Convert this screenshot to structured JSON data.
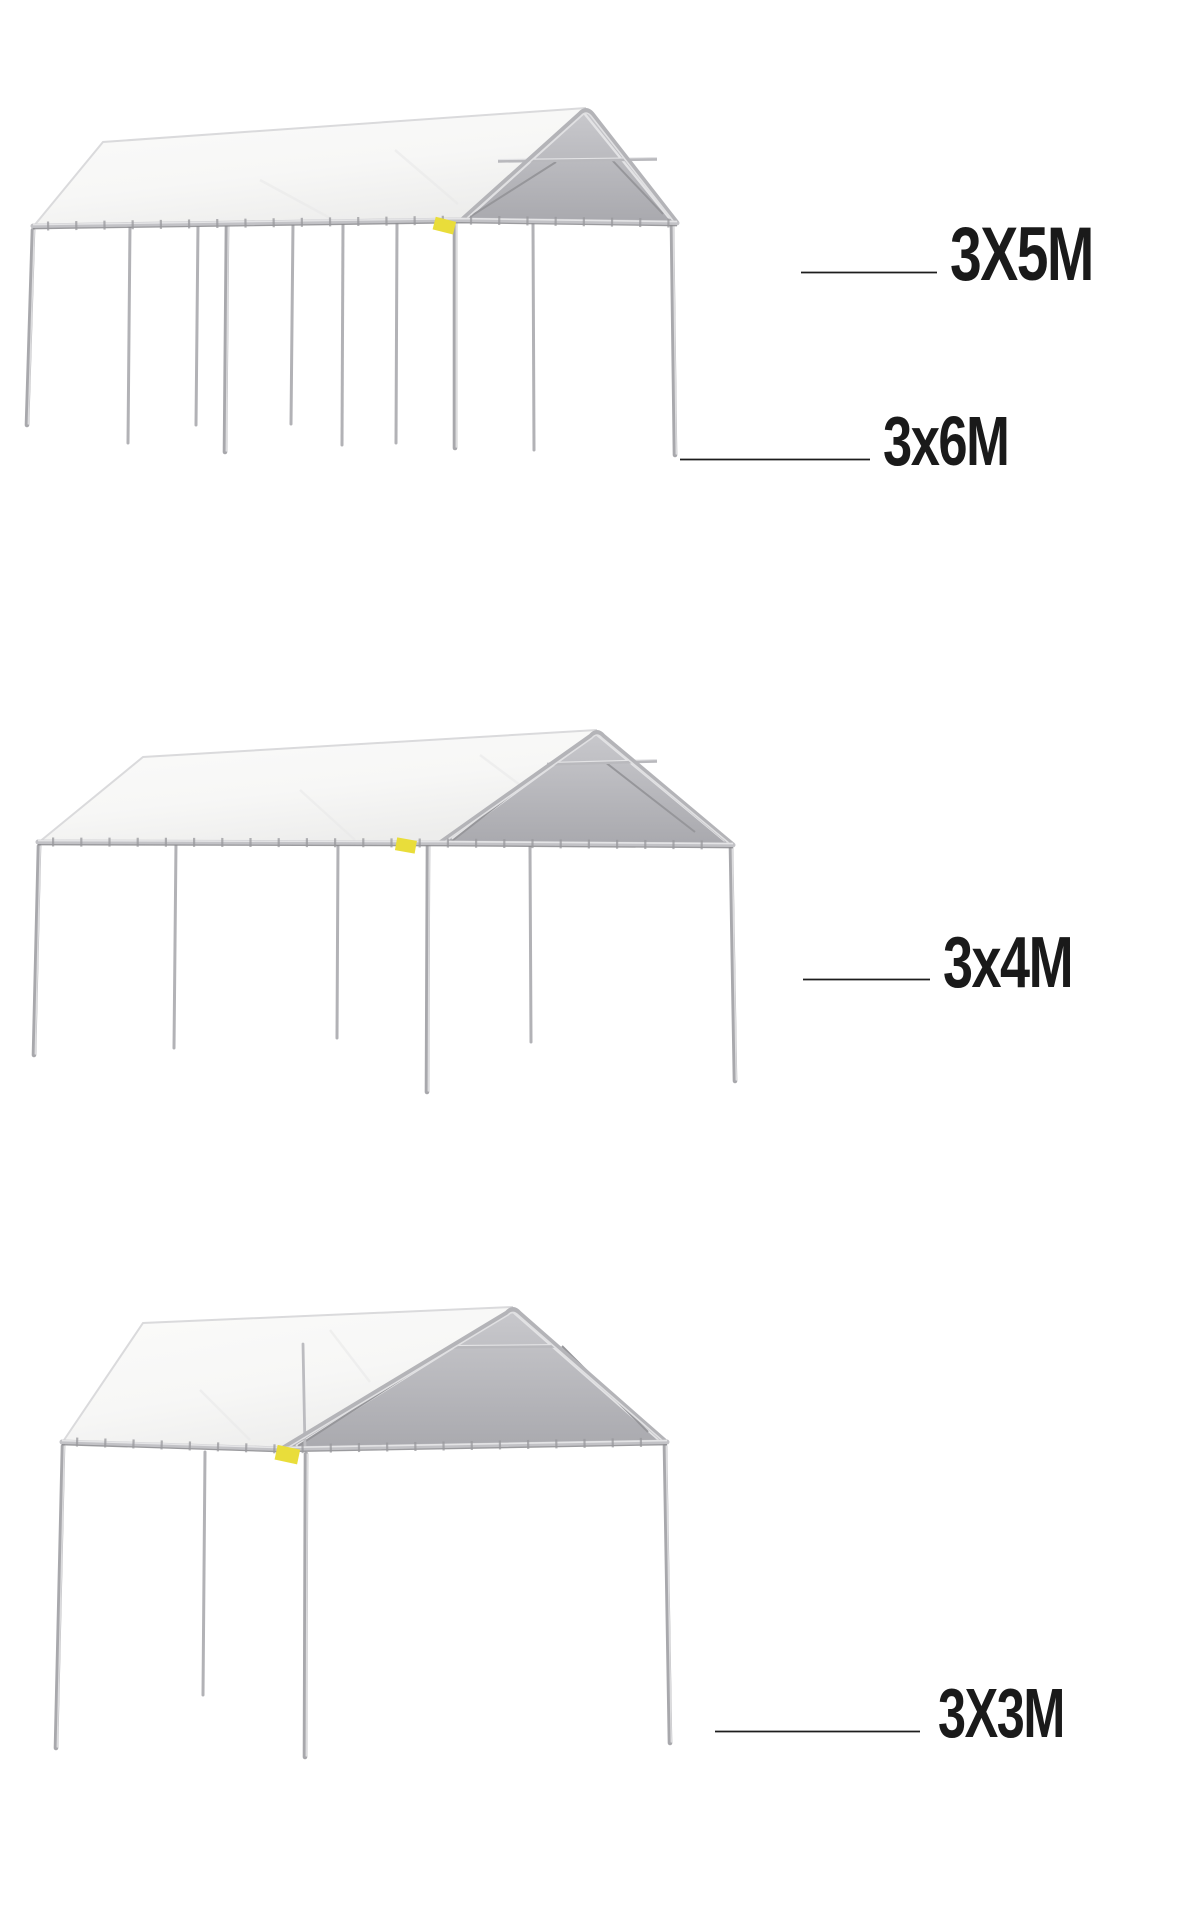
{
  "collage": {
    "items": [
      {
        "id": "tent-large",
        "labels": {
          "primary": "3X5M",
          "secondary": "3x6M"
        }
      },
      {
        "id": "tent-medium",
        "labels": {
          "primary": "3x4M"
        }
      },
      {
        "id": "tent-small",
        "labels": {
          "primary": "3X3M"
        }
      }
    ]
  },
  "colors": {
    "background": "#ffffff",
    "tarp_white": "#f7f7f6",
    "gable_gray_light": "#c9c9cd",
    "gable_gray_dark": "#a9a9ae",
    "frame_metal": "#a8a8ac",
    "frame_highlight": "#dcdcde",
    "frame_shadow": "#87878b",
    "tag_yellow": "#e9dd3a",
    "label_text": "#1a1a1a",
    "leader_line": "#1d1d1d"
  }
}
